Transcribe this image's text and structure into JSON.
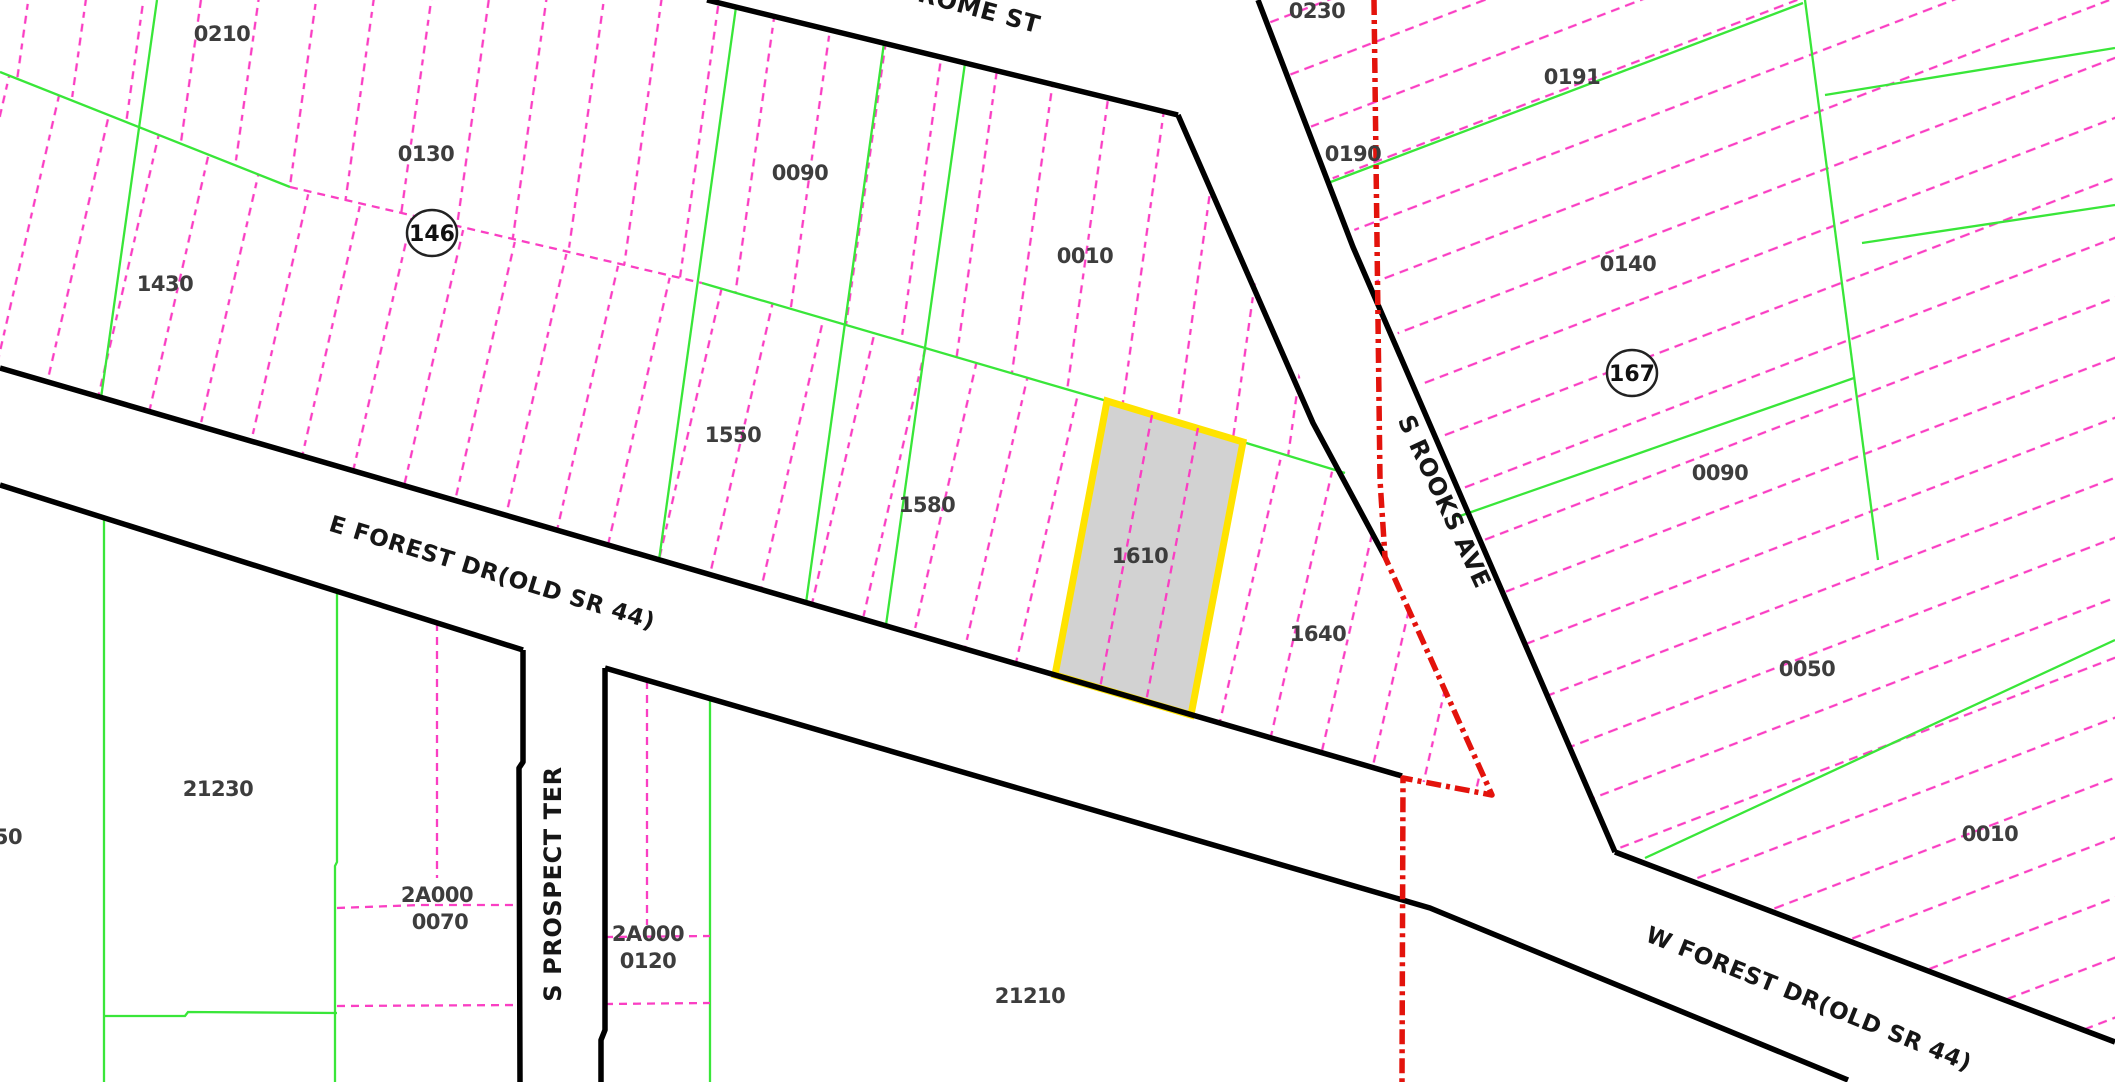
{
  "map": {
    "background": "#ffffff",
    "colors": {
      "road": "#000000",
      "lot_line": "#fa3fc3",
      "block_line": "#39e639",
      "boundary": "#e3130c",
      "highlight_stroke": "#ffe300",
      "highlight_fill": "#d2d2d2",
      "parcel_label": "#3d3d3d",
      "street_label": "#161616",
      "circle_stroke": "#222222"
    },
    "street_labels": [
      {
        "name": "jerome-st",
        "text": "ROME ST",
        "x": 977,
        "y": 17,
        "rotate": 15,
        "size": 24
      },
      {
        "name": "s-rooks-ave",
        "text": "S ROOKS AVE",
        "x": 1437,
        "y": 505,
        "rotate": 65,
        "size": 24
      },
      {
        "name": "s-prospect-ter",
        "text": "S PROSPECT TER",
        "x": 561,
        "y": 884,
        "rotate": -90,
        "size": 24
      },
      {
        "name": "e-forest-dr",
        "text": "E FOREST DR(OLD SR 44)",
        "x": 490,
        "y": 580,
        "rotate": 17,
        "size": 23
      },
      {
        "name": "w-forest-dr",
        "text": "W FOREST DR(OLD SR 44)",
        "x": 1806,
        "y": 1006,
        "rotate": 22,
        "size": 23
      }
    ],
    "parcel_labels": [
      {
        "text": "0210",
        "x": 222,
        "y": 33
      },
      {
        "text": "0130",
        "x": 426,
        "y": 153
      },
      {
        "text": "1430",
        "x": 165,
        "y": 283
      },
      {
        "text": "0090",
        "x": 800,
        "y": 172
      },
      {
        "text": "0010",
        "x": 1085,
        "y": 255
      },
      {
        "text": "1550",
        "x": 733,
        "y": 434
      },
      {
        "text": "1580",
        "x": 927,
        "y": 504
      },
      {
        "text": "1610",
        "x": 1140,
        "y": 555
      },
      {
        "text": "1640",
        "x": 1318,
        "y": 633
      },
      {
        "text": "0230",
        "x": 1317,
        "y": 10
      },
      {
        "text": "0190",
        "x": 1353,
        "y": 153
      },
      {
        "text": "0191",
        "x": 1572,
        "y": 76
      },
      {
        "text": "0140",
        "x": 1628,
        "y": 263
      },
      {
        "text": "0090",
        "x": 1720,
        "y": 472
      },
      {
        "text": "0050",
        "x": 1807,
        "y": 668
      },
      {
        "text": "0010",
        "x": 1990,
        "y": 833
      },
      {
        "text": "21230",
        "x": 218,
        "y": 788
      },
      {
        "text": "21210",
        "x": 1030,
        "y": 995
      },
      {
        "text": "50",
        "x": 8,
        "y": 836
      },
      {
        "text": "2A000",
        "x": 437,
        "y": 894
      },
      {
        "text": "0070",
        "x": 440,
        "y": 921
      },
      {
        "text": "2A000",
        "x": 648,
        "y": 933
      },
      {
        "text": "0120",
        "x": 648,
        "y": 960
      }
    ],
    "block_circles": [
      {
        "text": "146",
        "x": 432,
        "y": 233,
        "r": 23
      },
      {
        "text": "167",
        "x": 1632,
        "y": 373,
        "r": 23
      }
    ],
    "highlighted_parcel": {
      "label": "1610",
      "points": "1107,401 1243,442 1191,715 1055,675",
      "inner_lines": [
        [
          1152,
          415,
          1100,
          688
        ],
        [
          1198,
          428,
          1146,
          702
        ]
      ]
    },
    "pattern_blocks": [
      {
        "pattern": "lotVertA",
        "points": "0,0 707,0 1178,115 1345,473 1243,442 1107,401 702,283 290,187 0,72"
      },
      {
        "pattern": "lotVertB",
        "points": "0,72 290,187 702,283 1107,401 1243,442 1345,473 1385,557 1492,795 1403,778 0,368"
      },
      {
        "pattern": "lotDiag",
        "points": "1258,0 1615,852 2115,1042 2115,0"
      }
    ],
    "roads": [
      {
        "name": "jerome-st-south-edge",
        "points": "707,0 1178,115"
      },
      {
        "name": "s-rooks-west-edge",
        "points": "1178,115 1313,423 1385,557"
      },
      {
        "name": "s-rooks-east-edge",
        "points": "1258,0 1353,247 1615,852"
      },
      {
        "name": "forest-dr-north-edge",
        "points": "0,368 1402,776"
      },
      {
        "name": "w-forest-dr-north-edge",
        "points": "1615,852 2115,1042"
      },
      {
        "name": "e-forest-dr-south-edge",
        "points": "0,485 523,650"
      },
      {
        "name": "s-prospect-west-edge",
        "points": "523,650 523,762 519,768 520,1082"
      },
      {
        "name": "forest-dr-south-edge",
        "points": "605,668 1430,908 1848,1080"
      },
      {
        "name": "s-prospect-east-edge",
        "points": "605,668 605,1030 601,1040 601,1082"
      }
    ],
    "boundary_path": "1374,0 1380,480 1385,557 1492,795 1403,778 1402,1082",
    "green_lines": [
      {
        "name": "block-spine-green-1",
        "points": "0,72 290,187"
      },
      {
        "name": "block-spine-green-2",
        "points": "702,283 1107,401"
      },
      {
        "name": "block-spine-green-3",
        "points": "1243,442 1345,473"
      },
      {
        "name": "lot-green-1",
        "points": "157,0 101,398"
      },
      {
        "name": "lot-green-2",
        "points": "736,7 659,560"
      },
      {
        "name": "lot-green-3",
        "points": "884,43 806,603"
      },
      {
        "name": "lot-green-4",
        "points": "965,63 886,625"
      },
      {
        "name": "lot-green-5",
        "points": "104,518 104,1082"
      },
      {
        "name": "lot-green-6",
        "points": "337,591 337,862 335,866 335,1082"
      },
      {
        "name": "lot-green-7",
        "points": "104,1016 185,1016 188,1012 337,1013"
      },
      {
        "name": "lot-green-8",
        "points": "710,700 710,1082"
      },
      {
        "name": "lot-green-9",
        "points": "1328,183 1803,3"
      },
      {
        "name": "lot-green-10",
        "points": "1457,517 1854,378"
      },
      {
        "name": "lot-green-11",
        "points": "1805,0 1878,560"
      },
      {
        "name": "lot-green-12",
        "points": "1825,95 2115,48"
      },
      {
        "name": "lot-green-13",
        "points": "1862,243 2115,205"
      },
      {
        "name": "lot-green-14",
        "points": "1645,858 2115,640"
      }
    ],
    "pink_lines": [
      {
        "name": "block-spine-pink",
        "points": "290,187 702,283"
      },
      {
        "name": "lot-pink-1",
        "points": "437,623 437,878"
      },
      {
        "name": "lot-pink-2",
        "points": "337,908 420,905 521,905"
      },
      {
        "name": "lot-pink-3",
        "points": "337,1006 521,1005"
      },
      {
        "name": "lot-pink-4",
        "points": "647,681 647,925"
      },
      {
        "name": "lot-pink-5",
        "points": "605,937 710,936"
      },
      {
        "name": "lot-pink-6",
        "points": "605,1004 710,1003"
      }
    ]
  }
}
